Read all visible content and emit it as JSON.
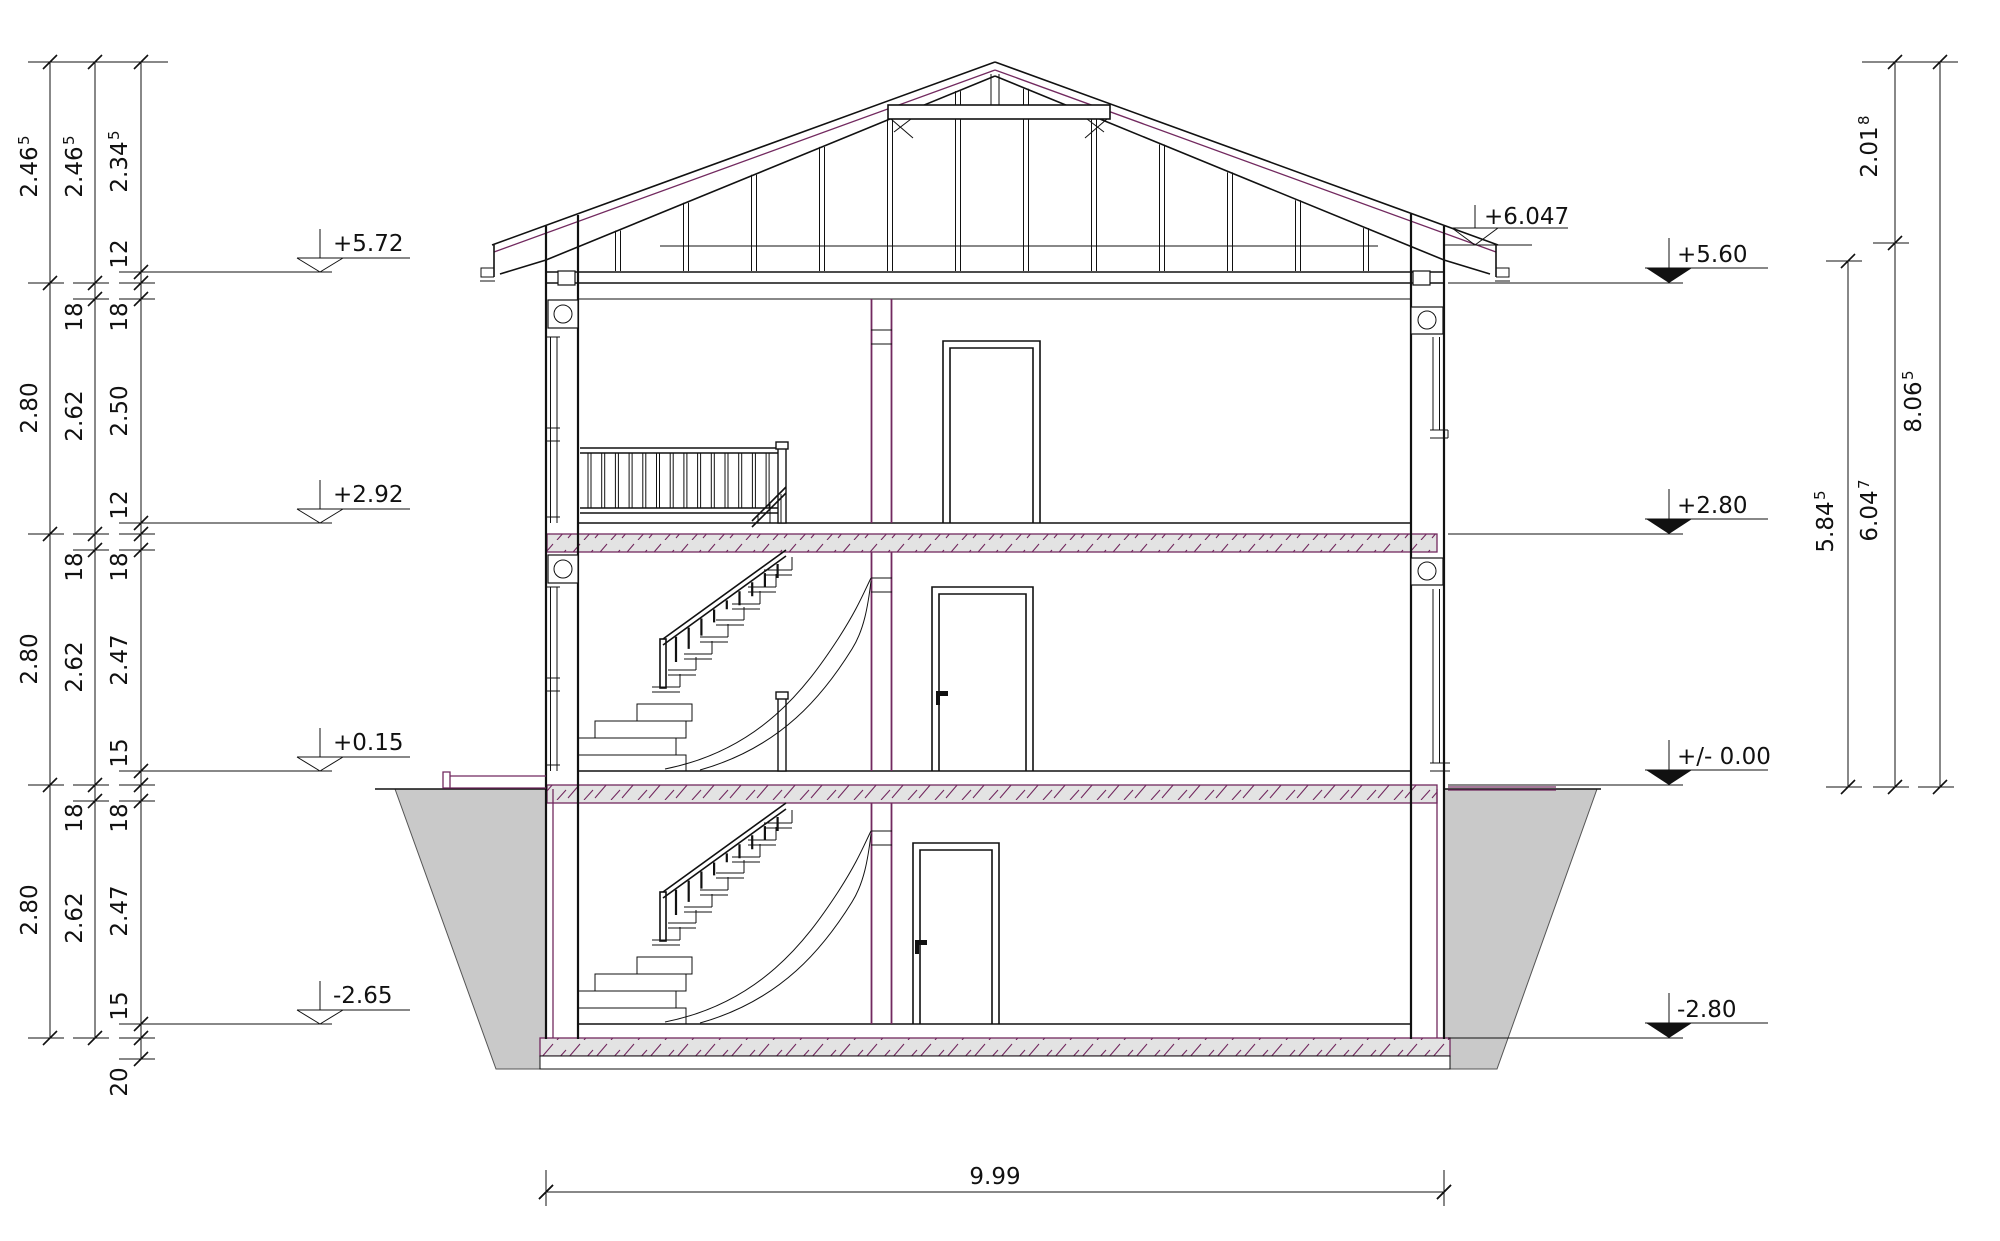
{
  "drawing": {
    "type": "architectural-building-section",
    "colors": {
      "line": "#111111",
      "accent_magenta": "#72295f",
      "earth_fill": "#c9c9c9",
      "slab_fill": "#e3e3e3"
    }
  },
  "dims": {
    "chain1": [
      {
        "v": "2.46",
        "s": "5"
      },
      {
        "v": "2.80"
      },
      {
        "v": "2.80"
      },
      {
        "v": "2.80"
      }
    ],
    "chain2": [
      {
        "v": "2.46",
        "s": "5"
      },
      {
        "v": "18"
      },
      {
        "v": "2.62"
      },
      {
        "v": "18"
      },
      {
        "v": "2.62"
      },
      {
        "v": "18"
      },
      {
        "v": "2.62"
      }
    ],
    "chain3": [
      {
        "v": "2.34",
        "s": "5"
      },
      {
        "v": "12"
      },
      {
        "v": "18"
      },
      {
        "v": "2.50"
      },
      {
        "v": "12"
      },
      {
        "v": "18"
      },
      {
        "v": "2.47"
      },
      {
        "v": "15"
      },
      {
        "v": "18"
      },
      {
        "v": "2.47"
      },
      {
        "v": "15"
      },
      {
        "v": "20"
      }
    ],
    "right": [
      {
        "v": "5.84",
        "s": "5"
      },
      {
        "v": "6.04",
        "s": "7"
      },
      {
        "v": "2.01",
        "s": "8"
      },
      {
        "v": "8.06",
        "s": "5"
      }
    ],
    "width": {
      "v": "9.99"
    }
  },
  "levels": {
    "left": [
      "+5.72",
      "+2.92",
      "+0.15",
      "-2.65"
    ],
    "right": [
      "+5.60",
      "+2.80",
      "+/- 0.00",
      "-2.80"
    ],
    "right_eave": "+6.047"
  }
}
